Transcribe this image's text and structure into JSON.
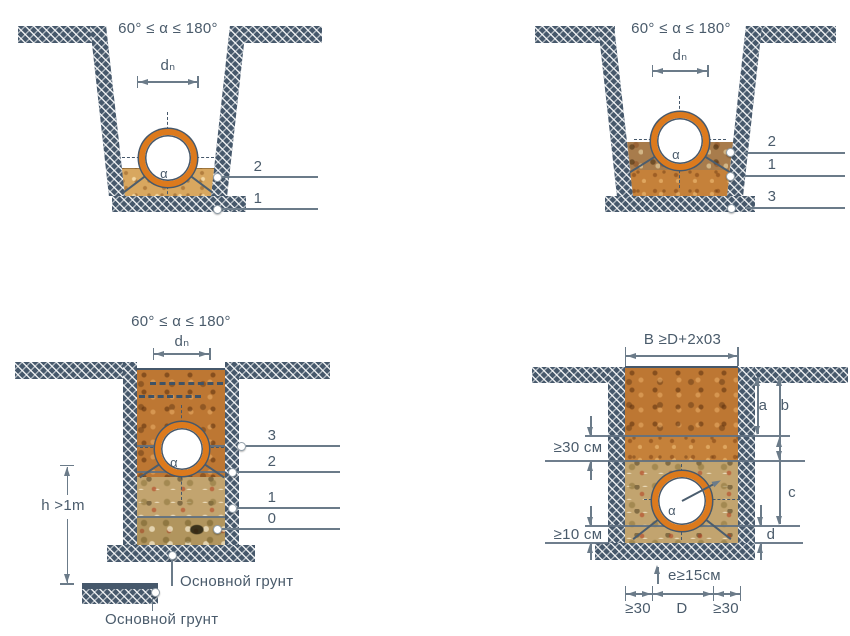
{
  "colors": {
    "slate": "#46586b",
    "dim_line": "#6b7b89",
    "text": "#4a5b6b",
    "pipe_orange": "#dc7a1d",
    "sand": "#d8a75f",
    "soil_orange": "#c5813a",
    "soil_mottled": "#a87c4c",
    "soil_rocky": "#c2a46f"
  },
  "diagrams": {
    "top_left": {
      "angle_condition": "60° ≤ α ≤ 180°",
      "diameter_label": "dₙ",
      "alpha": "α",
      "callouts": [
        "2",
        "1"
      ]
    },
    "top_right": {
      "angle_condition": "60° ≤ α ≤ 180°",
      "diameter_label": "dₙ",
      "alpha": "α",
      "callouts": [
        "2",
        "1",
        "3"
      ]
    },
    "bottom_left": {
      "angle_condition": "60° ≤ α ≤ 180°",
      "diameter_label": "dₙ",
      "alpha": "α",
      "callouts": [
        "3",
        "2",
        "1",
        "0"
      ],
      "depth_label": "h >1m",
      "base_soil_label": "Основной грунт",
      "base_soil_label_2": "Основной грунт"
    },
    "bottom_right": {
      "width_condition": "B ≥D+2x03",
      "alpha": "α",
      "dim_a": "a",
      "dim_b": "b",
      "dim_c": "c",
      "dim_d": "d",
      "layer_top_min": "≥30 см",
      "layer_bottom_min": "≥10 см",
      "bedding_min": "e≥15см",
      "side_clearance_left": "≥30",
      "pipe_diameter": "D",
      "side_clearance_right": "≥30"
    }
  }
}
